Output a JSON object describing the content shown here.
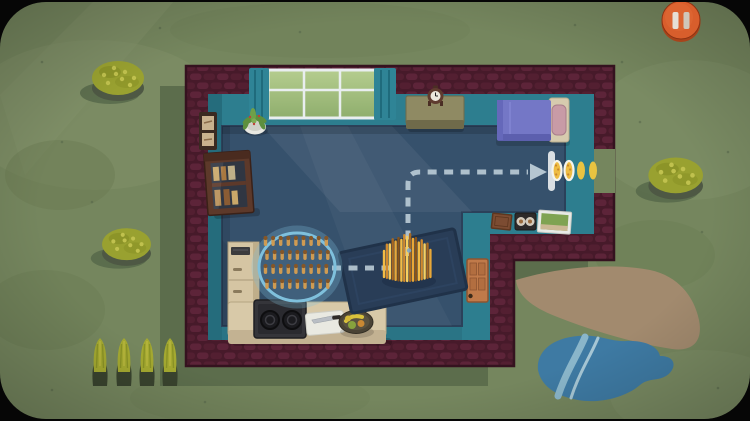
{
  "app": {
    "name": "top-down house game scene",
    "view": "duck-heist-map"
  },
  "hud": {
    "pause_button": {
      "icon": "pause-icon",
      "fill": "#d85e2c",
      "rim": "#a8431a",
      "bar_left": "#e6dfd5",
      "bar_right": "#cfc7bb"
    }
  },
  "palette": {
    "frame_black": "#060606",
    "grass": "#75865e",
    "grass_light": "#84946c",
    "grass_dark": "#687951",
    "house_shadow": "#5c6d4c",
    "brick": "#471a2a",
    "brick_light": "#5d2439",
    "wall_teal": "#2d7e8f",
    "floor": "#36516c",
    "rug": "#293d57",
    "route": "#c3d3dd",
    "corn": "#eebc43",
    "corn_shade": "#c8862e",
    "duck_body": "#cf9b52",
    "duck_head": "#845628",
    "flock_ring": "#7fc0dc",
    "path_tan": "#a28a6e",
    "pond": "#3e7aa3",
    "pond_stripe": "#8ab6ca",
    "pond_stripe2": "#a6c6d4",
    "bed_blanket": "#7477c6",
    "bed_frame": "#d6cbae",
    "bed_pillow": "#c89ba6",
    "counter": "#d8c9a8",
    "wood_dark": "#5d392a",
    "door_wood": "#c07a4a",
    "window_glass_top": "#b5cd8f",
    "window_glass_bottom": "#8fae6d",
    "curtain": "#2f8496",
    "bush": "#99a130",
    "bush_dots": "#c0c14e",
    "stalk": "#a4a930"
  },
  "scene": {
    "flock": {
      "name": "duckling-flock",
      "rows": 4,
      "per_row": 9,
      "total": 36
    },
    "corn_pile": {
      "name": "corn-pile-on-rug",
      "strands": 17
    },
    "corn_trail": {
      "name": "corn-trail-at-exit",
      "count": 4,
      "ringed": 2
    },
    "corn_stalks": {
      "name": "corn-stalk-row",
      "count": 4
    },
    "bushes": {
      "count": 3
    },
    "route": {
      "name": "planned-route",
      "style": "dashed",
      "direction": "to-exit-door"
    }
  }
}
